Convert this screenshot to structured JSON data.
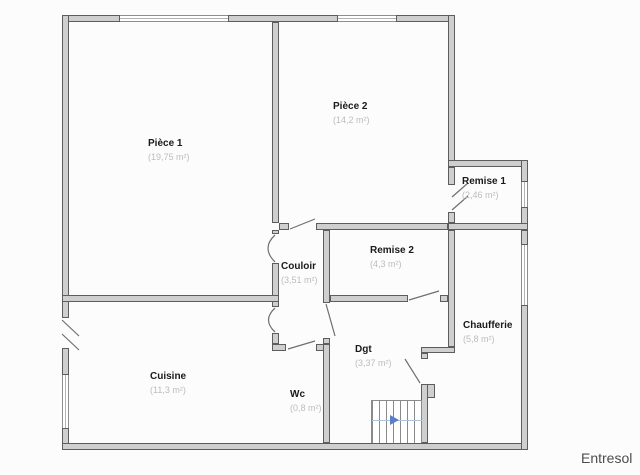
{
  "plan": {
    "level_label": "Entresol",
    "rooms": [
      {
        "id": "piece1",
        "name": "Pièce 1",
        "area": "(19,75 m²)"
      },
      {
        "id": "piece2",
        "name": "Pièce 2",
        "area": "(14,2 m²)"
      },
      {
        "id": "remise1",
        "name": "Remise 1",
        "area": "(2,46 m²)"
      },
      {
        "id": "remise2",
        "name": "Remise 2",
        "area": "(4,3 m²)"
      },
      {
        "id": "couloir",
        "name": "Couloir",
        "area": "(3,51 m²)"
      },
      {
        "id": "chaufferie",
        "name": "Chaufferie",
        "area": "(5,8 m²)"
      },
      {
        "id": "dgt",
        "name": "Dgt",
        "area": "(3,37 m²)"
      },
      {
        "id": "cuisine",
        "name": "Cuisine",
        "area": "(11,3 m²)"
      },
      {
        "id": "wc",
        "name": "Wc",
        "area": "(0,8 m²)"
      }
    ],
    "icons": {
      "stair_direction_arrow": "right-arrow"
    },
    "colors": {
      "wall_fill": "#cfcfcf",
      "wall_edge": "#5d5d5d",
      "room_text": "#1a1a1a",
      "area_text": "#bcbcbc",
      "window_line": "#8e8e8e",
      "stair_arrow": "#5b7fc7",
      "level_text": "#4d4d4d"
    }
  }
}
